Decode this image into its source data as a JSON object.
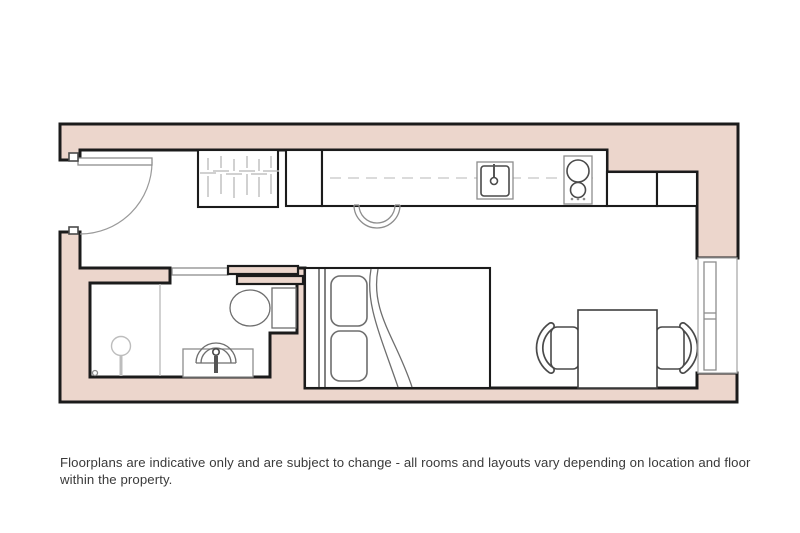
{
  "disclaimer": "Floorplans are indicative only and are subject to change - all rooms and layouts vary depending on location and floor within the property.",
  "colors": {
    "wall_fill": "#ecd6cc",
    "line": "#1b1b1b",
    "bg": "#ffffff",
    "text": "#3a3a3a"
  },
  "floorplan": {
    "type": "studio apartment floorplan",
    "features": [
      "entry-door",
      "wardrobe",
      "tall-cabinet",
      "kitchen-counter",
      "kitchen-sink",
      "hob",
      "worktop-cabinets",
      "breakfast-stool",
      "bathroom",
      "shower",
      "washbasin",
      "toilet",
      "sliding-door",
      "double-bed",
      "dining-table",
      "dining-chairs",
      "window"
    ]
  }
}
